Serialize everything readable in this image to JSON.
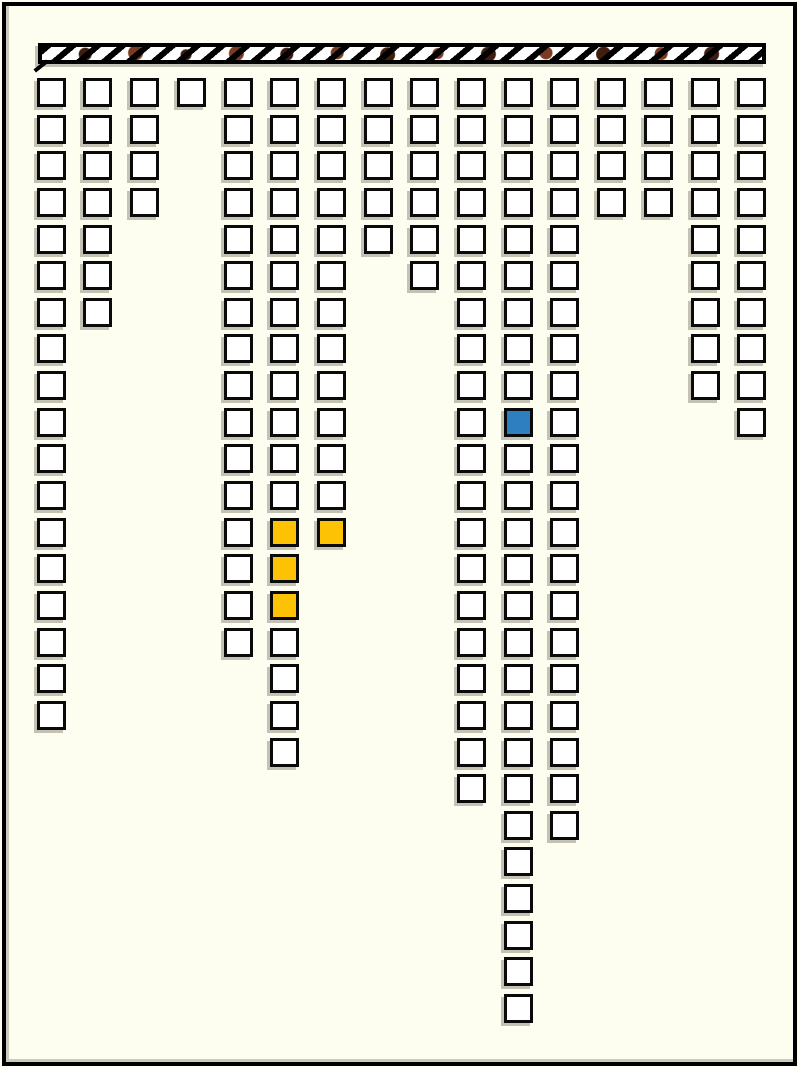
{
  "canvas": {
    "width": 800,
    "height": 1067,
    "background_color": "#FDFDF0",
    "frame_color": "#000000"
  },
  "ceiling_bar": {
    "x": 38,
    "y": 43,
    "width": 728,
    "height": 21,
    "fill_color": "#FFFFFF",
    "stripe_color": "#000000",
    "stripe_black_px": 6,
    "stripe_period_px": 16,
    "stripe_angle_deg": 140,
    "spots": [
      {
        "x_pct": 6,
        "y_pct": 55,
        "r": 6,
        "color": "#3F1D10"
      },
      {
        "x_pct": 13,
        "y_pct": 45,
        "r": 7,
        "color": "#7B3B22"
      },
      {
        "x_pct": 20,
        "y_pct": 60,
        "r": 5,
        "color": "#3F1D10"
      },
      {
        "x_pct": 27,
        "y_pct": 50,
        "r": 7,
        "color": "#7B3B22"
      },
      {
        "x_pct": 34,
        "y_pct": 55,
        "r": 6,
        "color": "#3F1D10"
      },
      {
        "x_pct": 41,
        "y_pct": 45,
        "r": 6,
        "color": "#7B3B22"
      },
      {
        "x_pct": 48,
        "y_pct": 60,
        "r": 7,
        "color": "#3F1D10"
      },
      {
        "x_pct": 55,
        "y_pct": 50,
        "r": 5,
        "color": "#7B3B22"
      },
      {
        "x_pct": 62,
        "y_pct": 55,
        "r": 7,
        "color": "#3F1D10"
      },
      {
        "x_pct": 70,
        "y_pct": 45,
        "r": 6,
        "color": "#7B3B22"
      },
      {
        "x_pct": 78,
        "y_pct": 55,
        "r": 7,
        "color": "#3F1D10"
      },
      {
        "x_pct": 86,
        "y_pct": 50,
        "r": 6,
        "color": "#7B3B22"
      },
      {
        "x_pct": 93,
        "y_pct": 55,
        "r": 7,
        "color": "#3F1D10"
      }
    ]
  },
  "grid": {
    "origin_x": 36.7,
    "origin_y": 78,
    "pitch_x": 46.7,
    "pitch_y": 36.64,
    "cell_size": 29,
    "cell_fill": "#FFFFFF",
    "cell_border_color": "#0A0A0A",
    "highlight_colors": {
      "yellow": "#FCC203",
      "blue": "#2E7FBF"
    },
    "columns": [
      {
        "col": 1,
        "cells": 18,
        "special": {}
      },
      {
        "col": 2,
        "cells": 7,
        "special": {}
      },
      {
        "col": 3,
        "cells": 4,
        "special": {}
      },
      {
        "col": 4,
        "cells": 1,
        "special": {}
      },
      {
        "col": 5,
        "cells": 16,
        "special": {}
      },
      {
        "col": 6,
        "cells": 19,
        "special": {
          "13": "yellow",
          "14": "yellow",
          "15": "yellow"
        }
      },
      {
        "col": 7,
        "cells": 13,
        "special": {
          "13": "yellow"
        }
      },
      {
        "col": 8,
        "cells": 5,
        "special": {}
      },
      {
        "col": 9,
        "cells": 6,
        "special": {}
      },
      {
        "col": 10,
        "cells": 20,
        "special": {}
      },
      {
        "col": 11,
        "cells": 26,
        "special": {
          "10": "blue"
        }
      },
      {
        "col": 12,
        "cells": 21,
        "special": {}
      },
      {
        "col": 13,
        "cells": 4,
        "special": {}
      },
      {
        "col": 14,
        "cells": 4,
        "special": {}
      },
      {
        "col": 15,
        "cells": 9,
        "special": {}
      },
      {
        "col": 16,
        "cells": 10,
        "special": {}
      }
    ]
  }
}
